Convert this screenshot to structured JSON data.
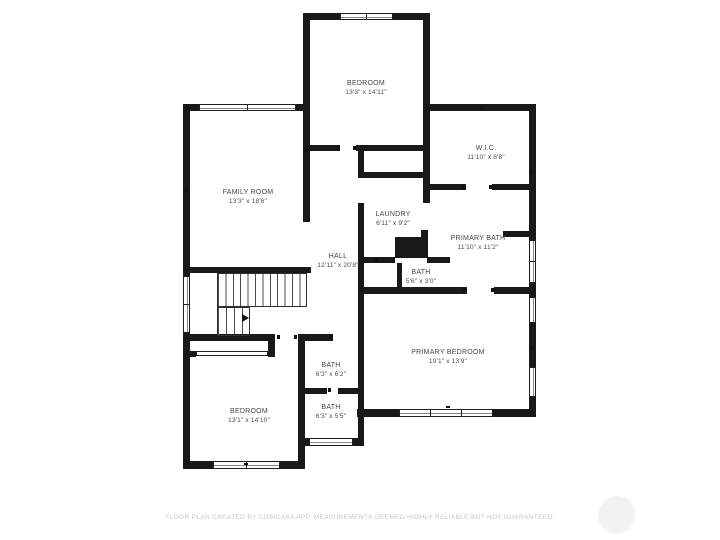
{
  "plan_title": "floor-plan",
  "colors": {
    "wall": "#191919",
    "label": "#454545",
    "disclaimer": "#c7c7c7",
    "background": "#ffffff"
  },
  "rooms": [
    {
      "id": "bedroom-top",
      "name": "BEDROOM",
      "dims": "13'3\" x 14'11\""
    },
    {
      "id": "wic",
      "name": "W.I.C.",
      "dims": "11'10\" x 8'8\""
    },
    {
      "id": "family-room",
      "name": "FAMILY ROOM",
      "dims": "13'3\" x 18'6\""
    },
    {
      "id": "laundry",
      "name": "LAUNDRY",
      "dims": "6'11\" x 9'2\""
    },
    {
      "id": "primary-bath",
      "name": "PRIMARY BATH",
      "dims": "11'10\" x 11'2\""
    },
    {
      "id": "hall",
      "name": "HALL",
      "dims": "12'11\" x 20'8\""
    },
    {
      "id": "bath-powder",
      "name": "BATH",
      "dims": "5'6\" x 3'0\""
    },
    {
      "id": "primary-bedroom",
      "name": "PRIMARY BEDROOM",
      "dims": "19'1\" x 13'9\""
    },
    {
      "id": "bath-upper",
      "name": "BATH",
      "dims": "6'3\" x 6'2\""
    },
    {
      "id": "bath-lower",
      "name": "BATH",
      "dims": "6'3\" x 5'5\""
    },
    {
      "id": "bedroom-bottom",
      "name": "BEDROOM",
      "dims": "13'1\" x 14'10\""
    }
  ],
  "footer": {
    "disclaimer": "FLOOR PLAN CREATED BY CUBICASA APP. MEASUREMENTS DEEMED HIGHLY RELIABLE BUT NOT GUARANTEED."
  }
}
